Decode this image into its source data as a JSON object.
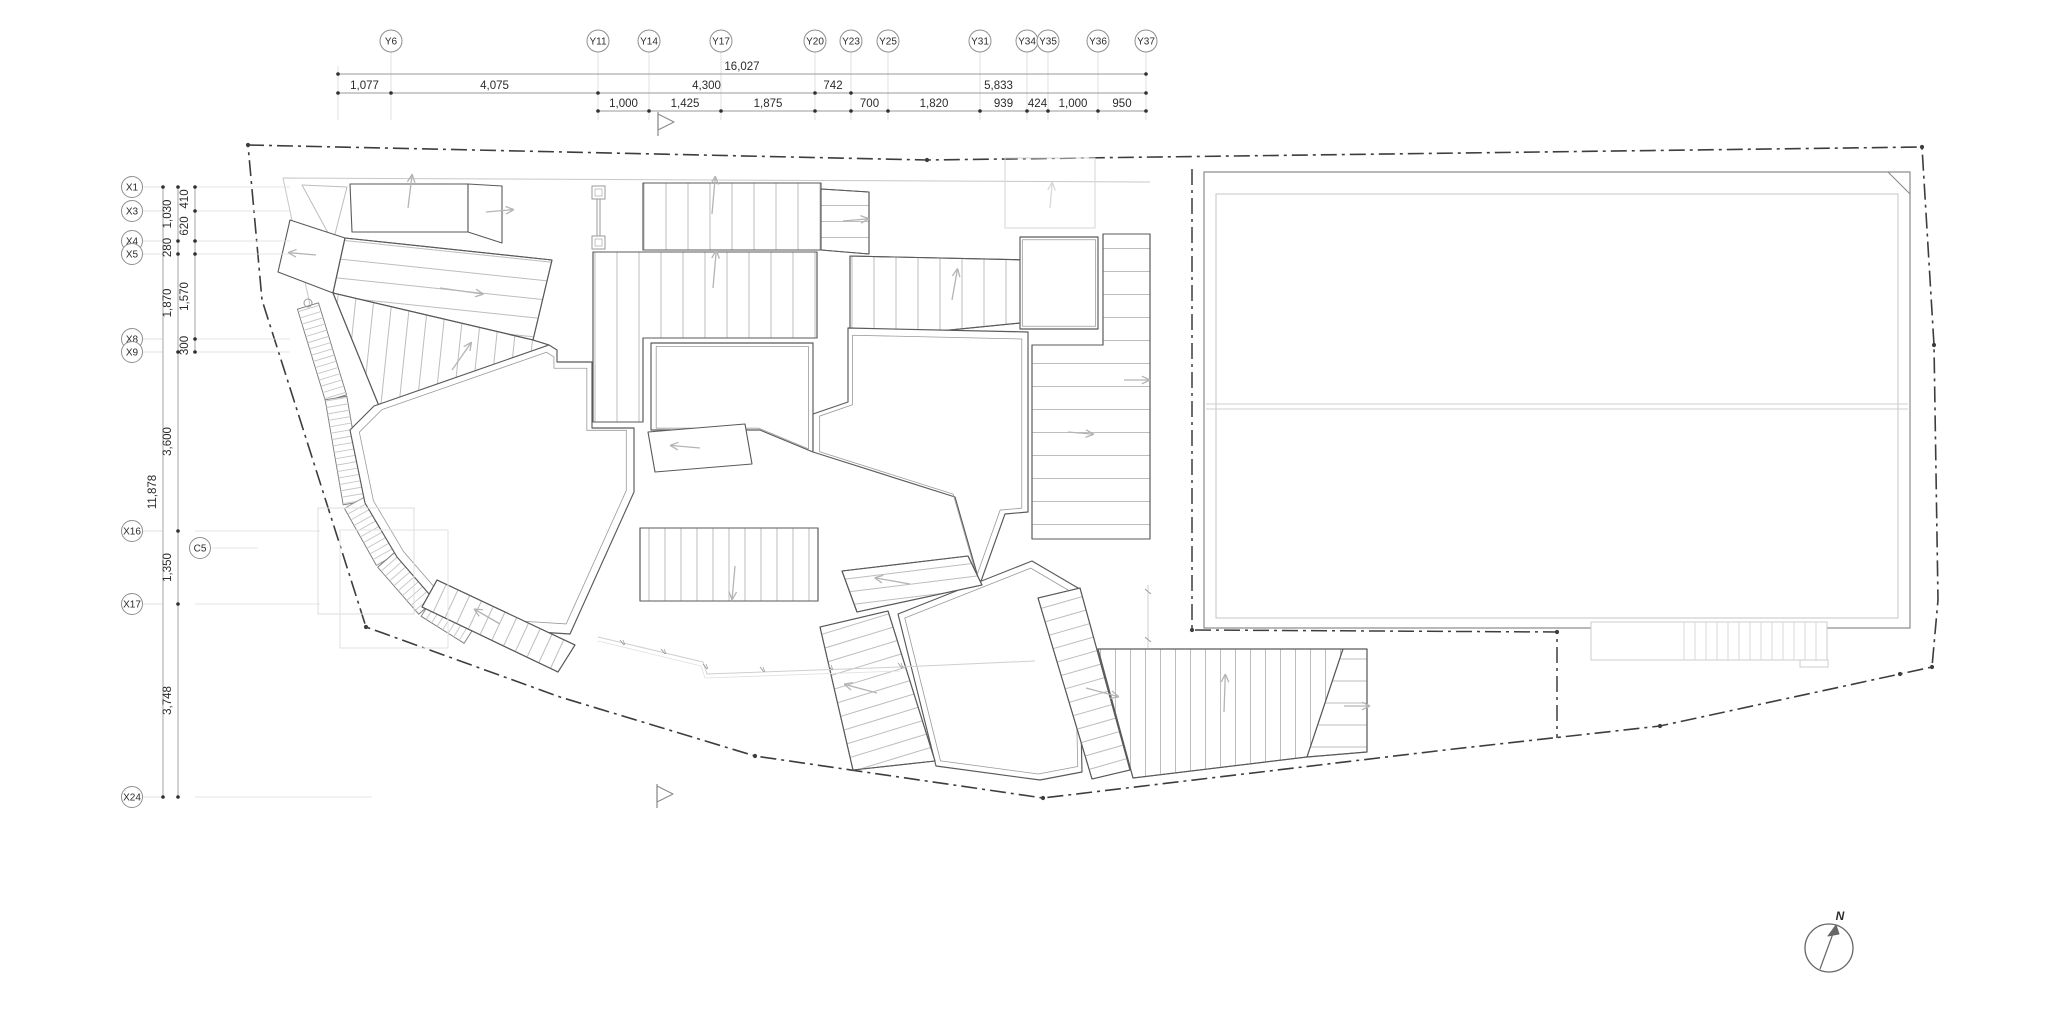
{
  "meta": {
    "drawing_type": "architectural roof plan",
    "background": "#ffffff"
  },
  "colors": {
    "boundary": "#3d3d3d",
    "outline": "#5a5a5a",
    "outline_light": "#8a8a8a",
    "hatch": "#bdbdbd",
    "faint": "#d5d5d5",
    "arrow": "#b4b4b4",
    "dim_line": "#9a9a9a",
    "leader": "#d8d8d8",
    "text": "#2b2b2b",
    "bubble": "#8f8f8f"
  },
  "north": {
    "label": "N"
  },
  "grid": {
    "top": {
      "bubble_y": 41,
      "bubbles": [
        {
          "label": "Y6",
          "x": 391
        },
        {
          "label": "Y11",
          "x": 598
        },
        {
          "label": "Y14",
          "x": 649
        },
        {
          "label": "Y17",
          "x": 721
        },
        {
          "label": "Y20",
          "x": 815
        },
        {
          "label": "Y23",
          "x": 851
        },
        {
          "label": "Y25",
          "x": 888
        },
        {
          "label": "Y31",
          "x": 980
        },
        {
          "label": "Y34",
          "x": 1027
        },
        {
          "label": "Y35",
          "x": 1048
        },
        {
          "label": "Y36",
          "x": 1098
        },
        {
          "label": "Y37",
          "x": 1146
        }
      ]
    },
    "left": {
      "bubble_x": 132,
      "bubbles": [
        {
          "label": "X1",
          "y": 187
        },
        {
          "label": "X3",
          "y": 211
        },
        {
          "label": "X4",
          "y": 241
        },
        {
          "label": "X5",
          "y": 254
        },
        {
          "label": "X8",
          "y": 339
        },
        {
          "label": "X9",
          "y": 352
        },
        {
          "label": "X16",
          "y": 531
        },
        {
          "label": "X17",
          "y": 604
        },
        {
          "label": "X24",
          "y": 797
        }
      ],
      "extra_bubble": {
        "label": "C5",
        "x": 200,
        "y": 548
      }
    }
  },
  "dims": {
    "top_rows": [
      {
        "y": 74,
        "line": [
          338,
          1146
        ],
        "ticks": [
          338,
          1146
        ],
        "segments": [
          {
            "label": "16,027",
            "from": 338,
            "to": 1146
          }
        ]
      },
      {
        "y": 93,
        "line": [
          338,
          1146
        ],
        "ticks": [
          338,
          391,
          598,
          815,
          851,
          1146
        ],
        "segments": [
          {
            "label": "1,077",
            "from": 338,
            "to": 391
          },
          {
            "label": "4,075",
            "from": 391,
            "to": 598
          },
          {
            "label": "4,300",
            "from": 598,
            "to": 815
          },
          {
            "label": "742",
            "from": 815,
            "to": 851
          },
          {
            "label": "5,833",
            "from": 851,
            "to": 1146
          }
        ]
      },
      {
        "y": 111,
        "line": [
          598,
          1146
        ],
        "ticks": [
          598,
          649,
          721,
          815,
          851,
          888,
          980,
          1027,
          1048,
          1098,
          1146
        ],
        "segments": [
          {
            "label": "1,000",
            "from": 598,
            "to": 649
          },
          {
            "label": "1,425",
            "from": 649,
            "to": 721
          },
          {
            "label": "1,875",
            "from": 721,
            "to": 815
          },
          {
            "label": "700",
            "from": 851,
            "to": 888
          },
          {
            "label": "1,820",
            "from": 888,
            "to": 980
          },
          {
            "label": "939",
            "from": 980,
            "to": 1027
          },
          {
            "label": "424",
            "from": 1027,
            "to": 1048
          },
          {
            "label": "1,000",
            "from": 1048,
            "to": 1098
          },
          {
            "label": "950",
            "from": 1098,
            "to": 1146
          }
        ]
      }
    ],
    "left_cols": [
      {
        "x": 163,
        "line": [
          187,
          797
        ],
        "ticks": [
          187,
          797
        ],
        "segments": [
          {
            "label": "11,878",
            "from": 187,
            "to": 797
          }
        ]
      },
      {
        "x": 178,
        "line": [
          187,
          797
        ],
        "ticks": [
          187,
          241,
          254,
          352,
          531,
          604,
          797
        ],
        "segments": [
          {
            "label": "1,030",
            "from": 187,
            "to": 241
          },
          {
            "label": "280",
            "from": 241,
            "to": 254
          },
          {
            "label": "1,870",
            "from": 254,
            "to": 352
          },
          {
            "label": "3,600",
            "from": 352,
            "to": 531
          },
          {
            "label": "1,350",
            "from": 531,
            "to": 604
          },
          {
            "label": "3,748",
            "from": 604,
            "to": 797
          }
        ]
      },
      {
        "x": 195,
        "line": [
          187,
          352
        ],
        "ticks": [
          187,
          211,
          241,
          254,
          339,
          352
        ],
        "segments": [
          {
            "label": "410",
            "from": 187,
            "to": 211
          },
          {
            "label": "620",
            "from": 211,
            "to": 241
          },
          {
            "label": "1,570",
            "from": 254,
            "to": 339
          },
          {
            "label": "300",
            "from": 339,
            "to": 352
          }
        ]
      }
    ]
  }
}
